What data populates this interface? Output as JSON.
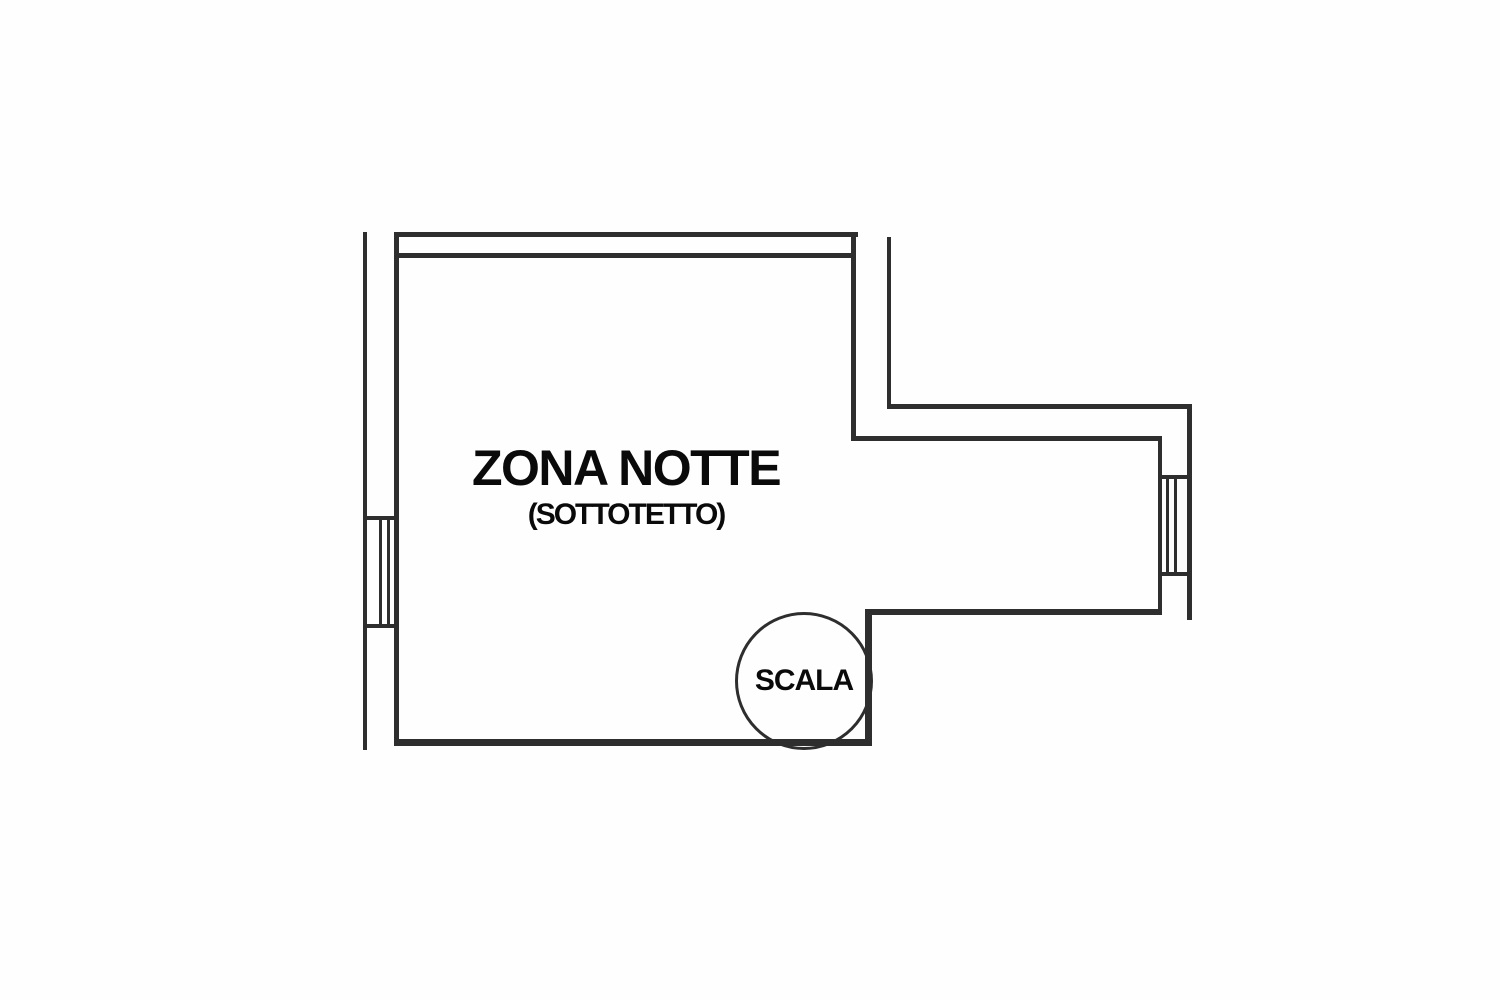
{
  "plan": {
    "room": {
      "label": "ZONA NOTTE",
      "sublabel": "(SOTTOTETTO)"
    },
    "staircase": {
      "label": "SCALA"
    },
    "colors": {
      "line": "#2e2e2e",
      "text": "#0a0a0a",
      "background": "#fefefe"
    }
  }
}
